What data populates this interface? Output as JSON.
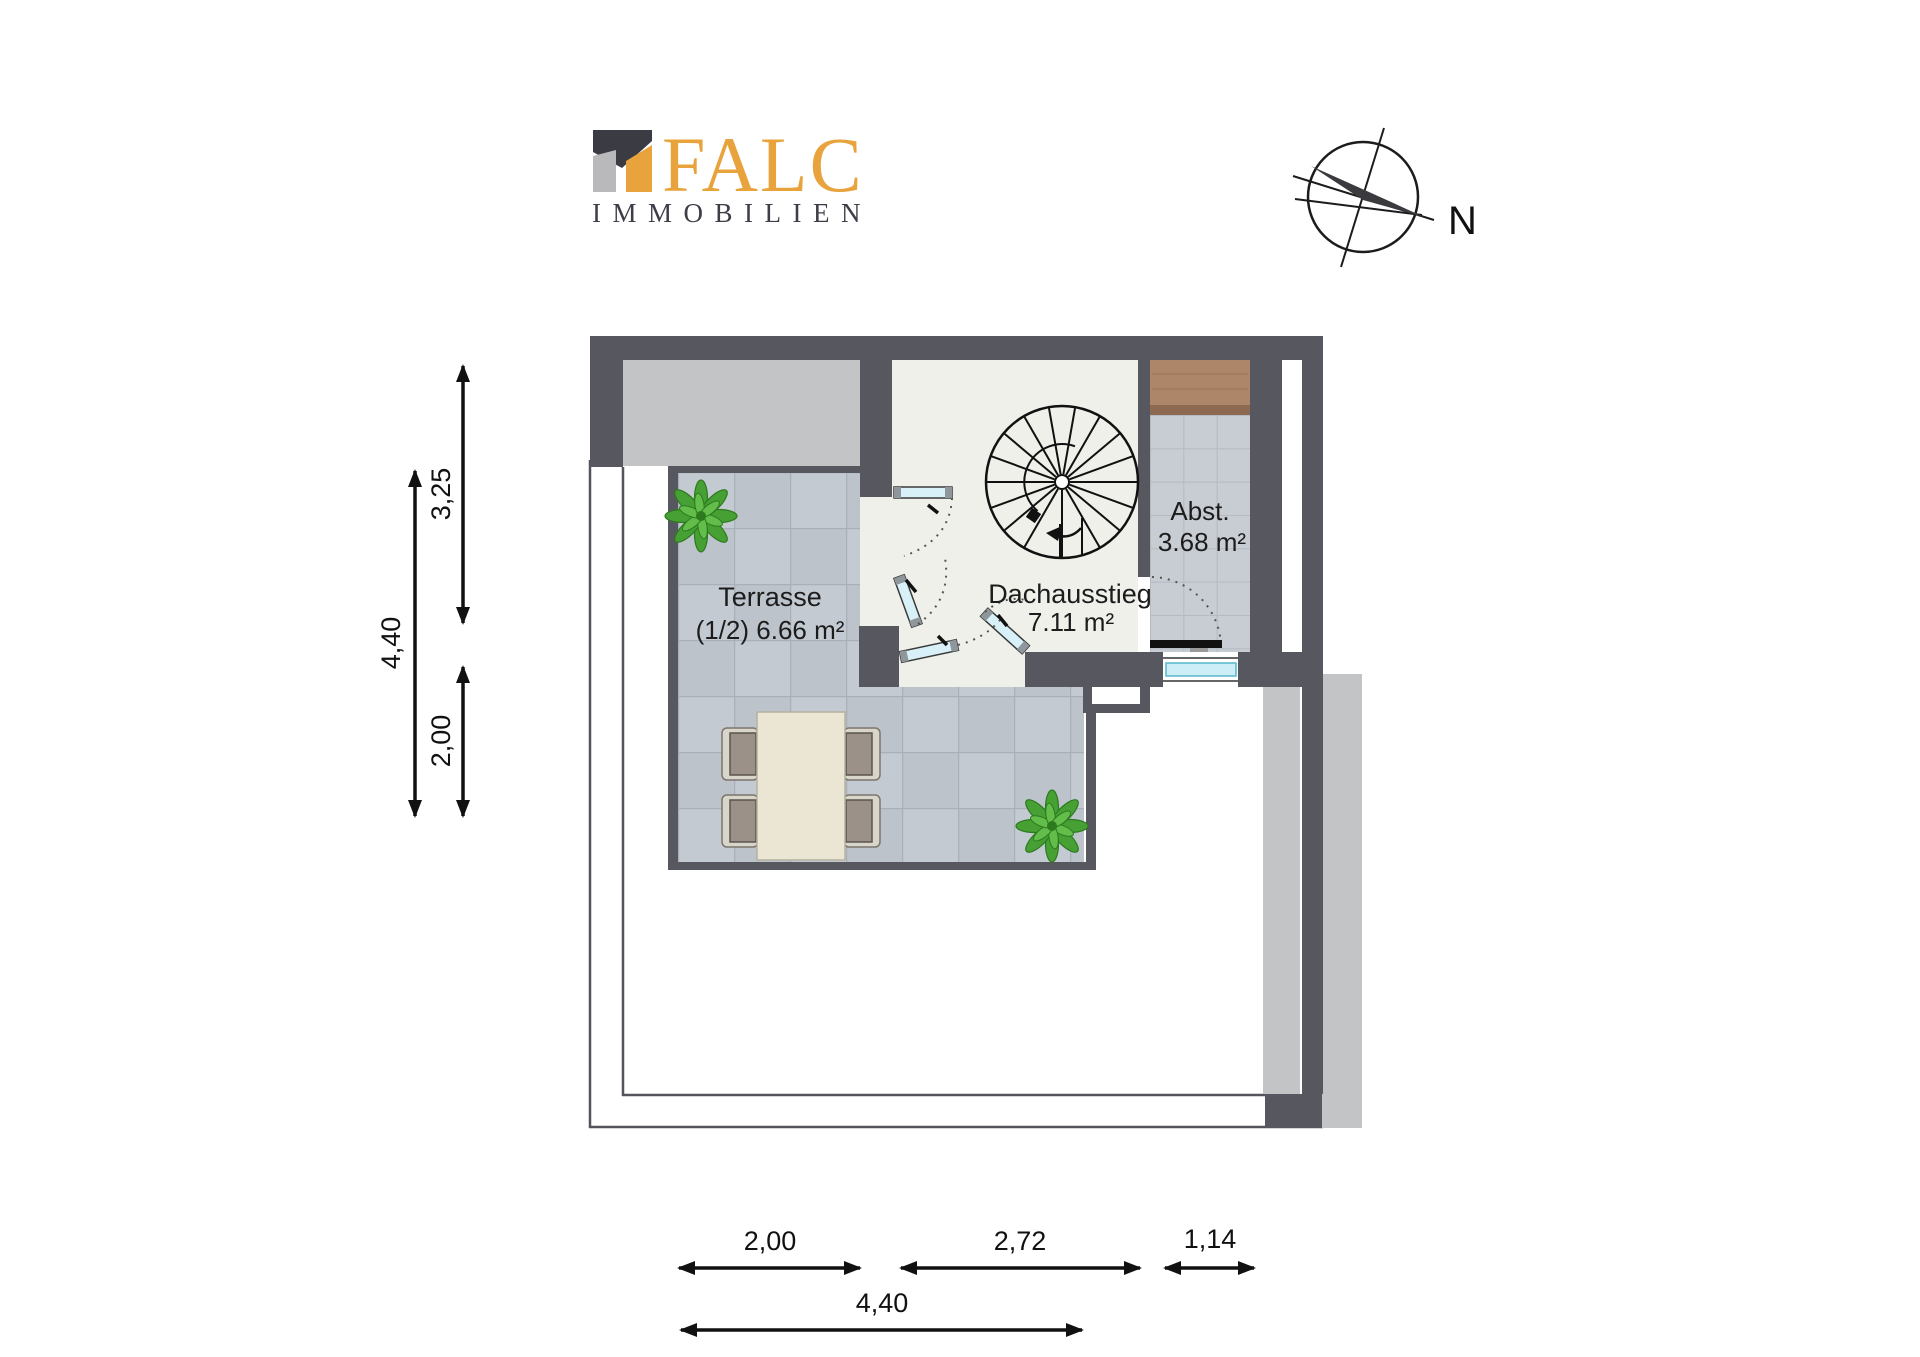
{
  "logo": {
    "brand": "FALC",
    "subtitle": "IMMOBILIEN"
  },
  "compass": {
    "north_label": "N"
  },
  "rooms": {
    "terrasse": {
      "name": "Terrasse",
      "area": "(1/2) 6.66 m²"
    },
    "dachausstieg": {
      "name": "Dachausstieg",
      "area": "7.11 m²"
    },
    "abstellraum": {
      "name": "Abst.",
      "area": "3.68 m²"
    }
  },
  "dimensions": {
    "left": [
      {
        "label": "3,25"
      },
      {
        "label": "4,40"
      },
      {
        "label": "2,00"
      }
    ],
    "bottom": [
      {
        "label": "2,00"
      },
      {
        "label": "2,72"
      },
      {
        "label": "1,14"
      },
      {
        "label": "4,40"
      }
    ]
  },
  "colors": {
    "brand_orange": "#E8A33D",
    "logo_dark": "#3E3E48",
    "wall_dark": "#57575F",
    "roof_gray": "#C3C4C6",
    "terrace_tile": "#BCC3CB",
    "abst_tile": "#C8CDD4",
    "room_floor": "#EFF0EA",
    "wood": "#AD8568",
    "glass_blue": "#D8F1F8",
    "window_cyan": "#CDEEF6",
    "plant_green": "#47A033",
    "table_cream": "#EAE6D3"
  }
}
